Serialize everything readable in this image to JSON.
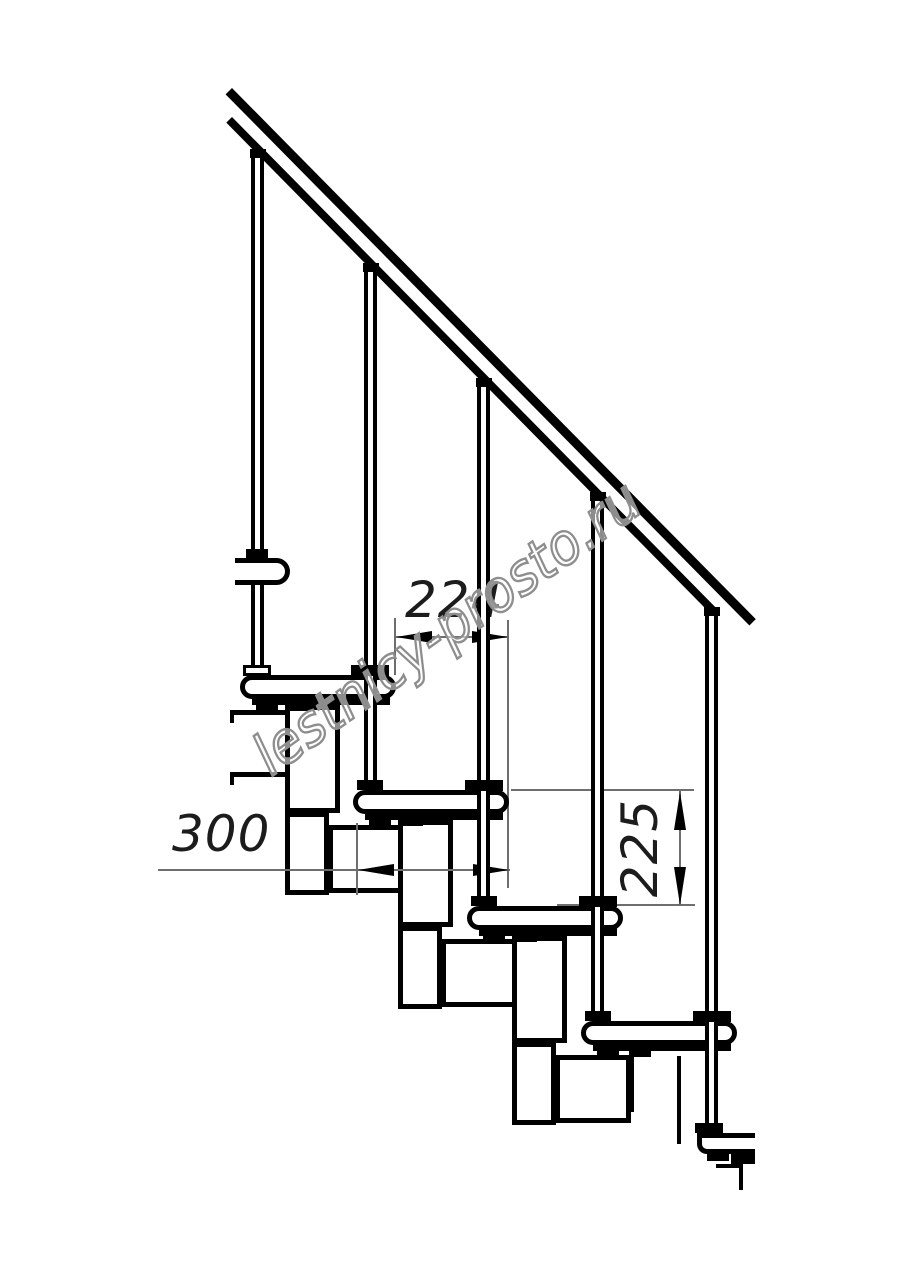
{
  "drawing": {
    "type": "modular-staircase-side-view",
    "watermark": "lestnicy-prosto.ru",
    "dimensions": {
      "step_run": "224",
      "tread_depth": "300",
      "riser_height": "225"
    }
  }
}
